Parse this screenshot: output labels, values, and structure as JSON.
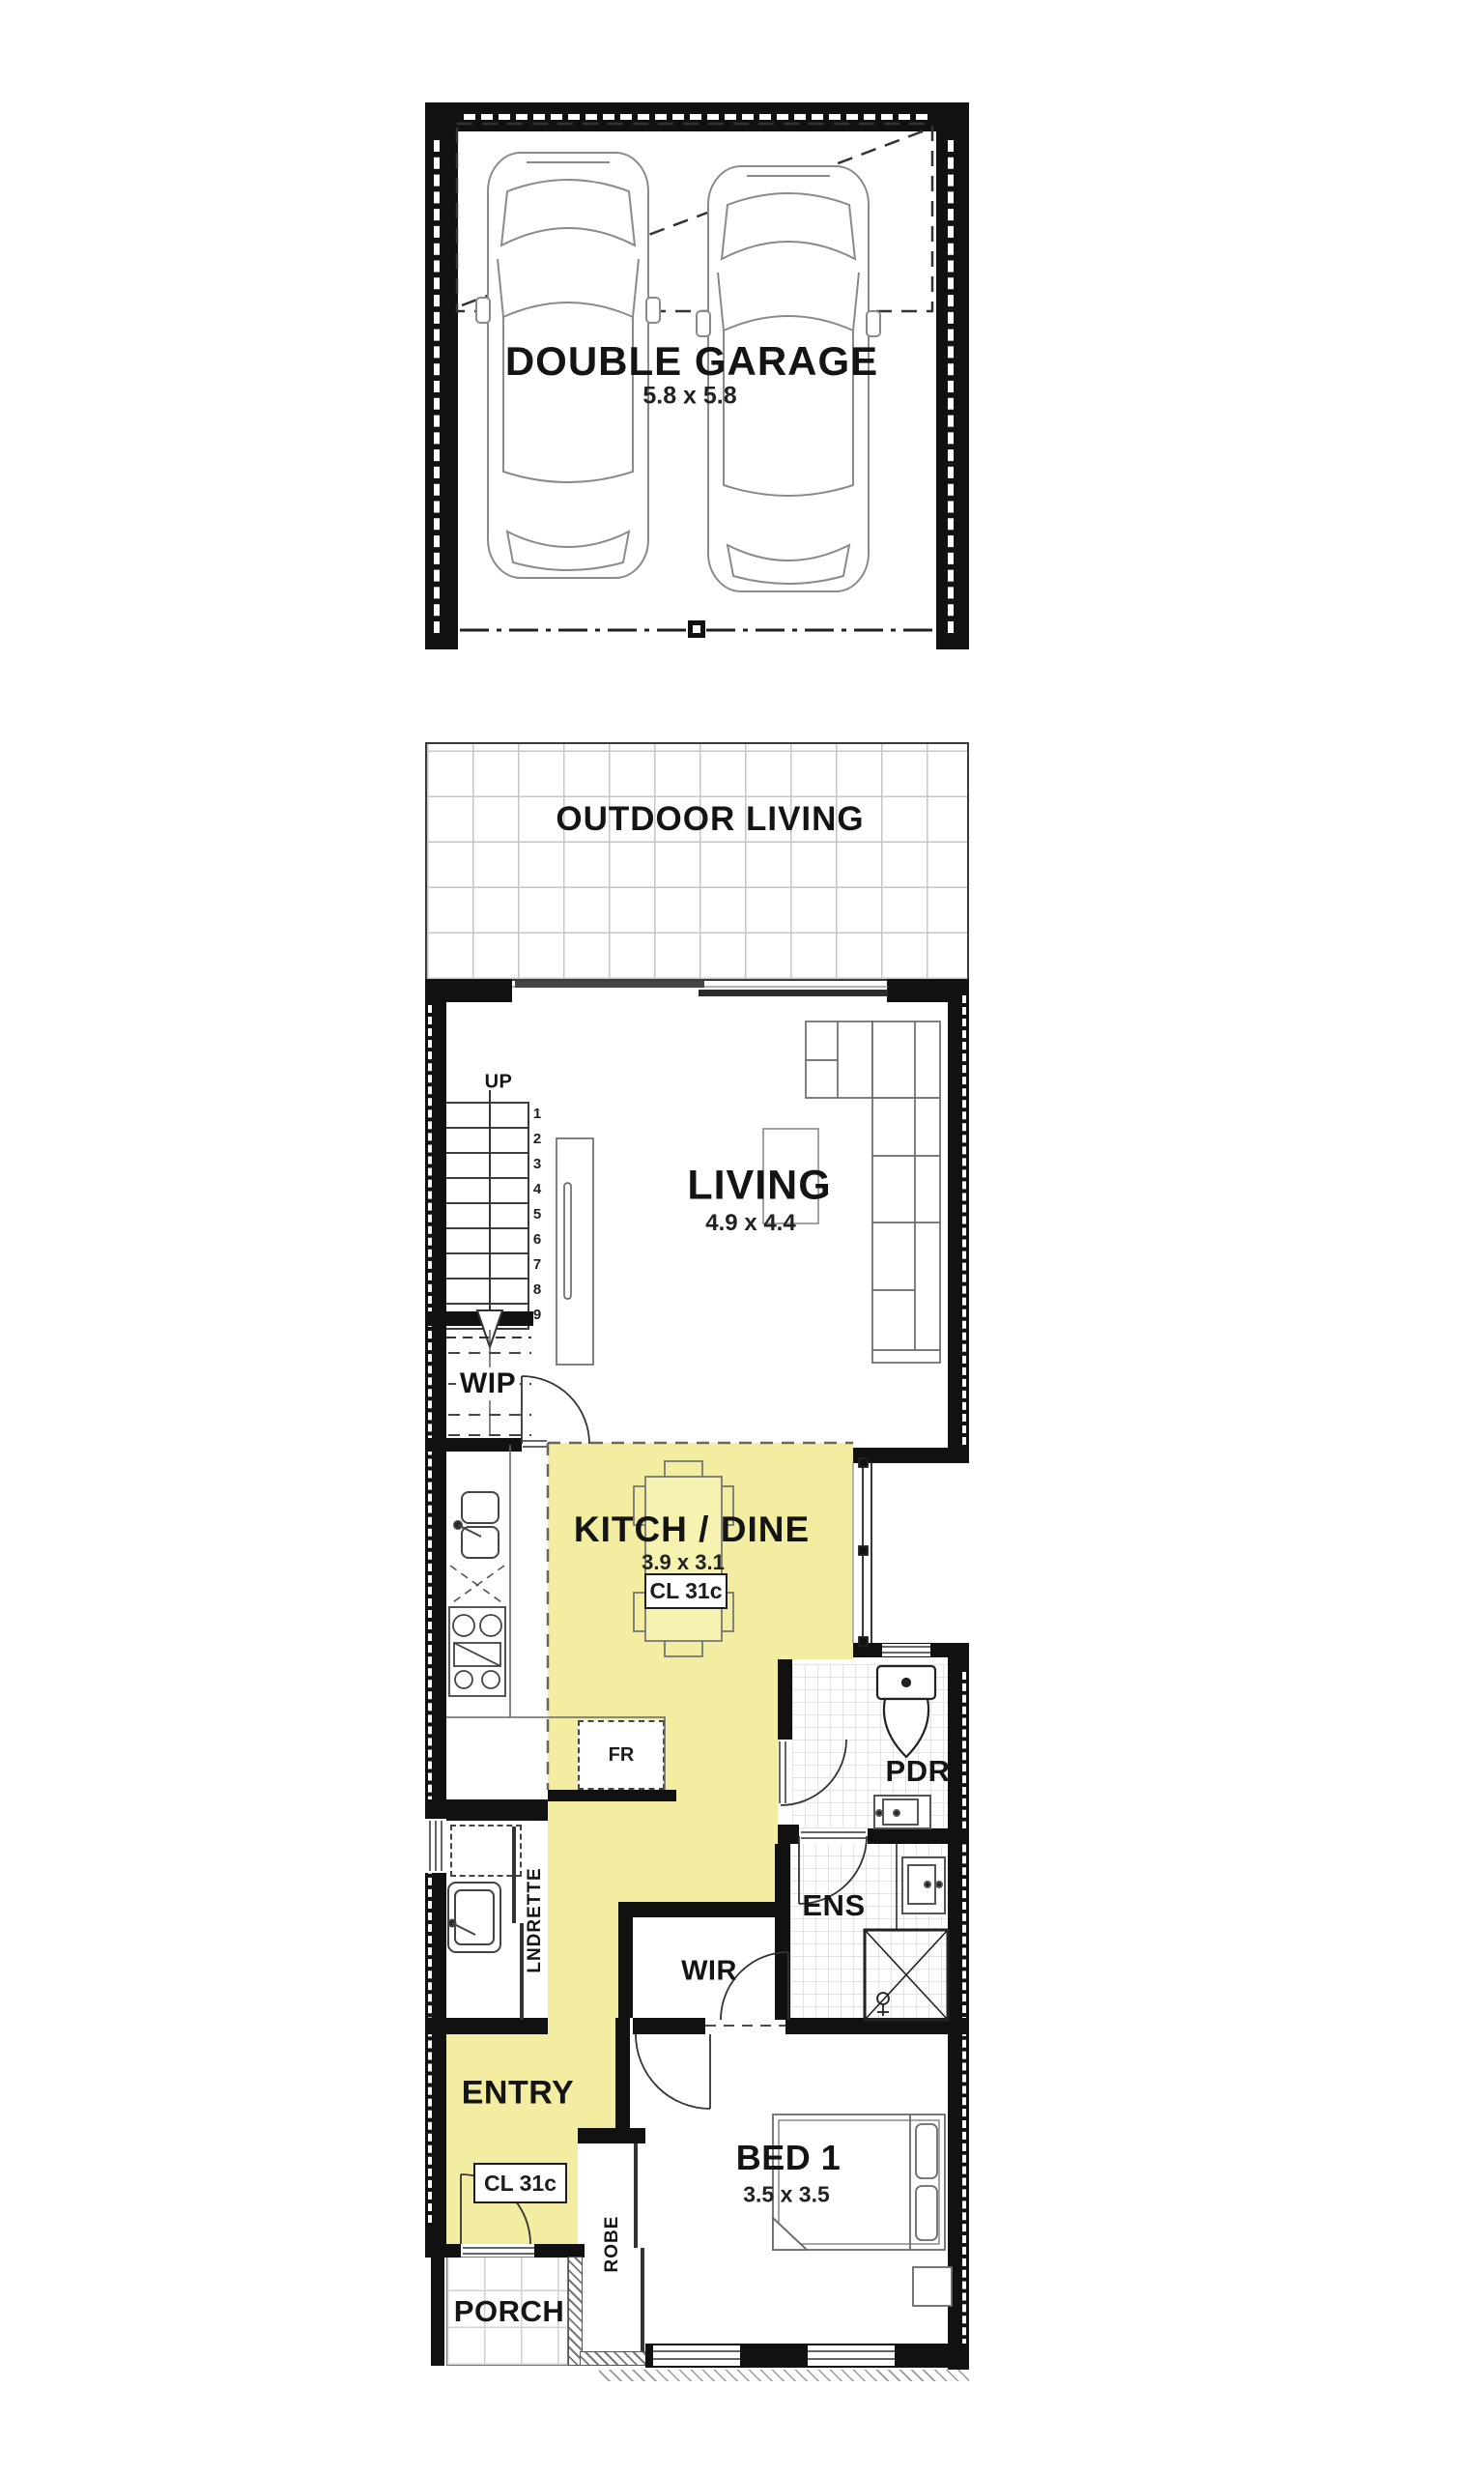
{
  "colors": {
    "highlight": "#F2EDA0",
    "wall": "#111111",
    "line": "#555555"
  },
  "garage": {
    "label": "DOUBLE GARAGE",
    "dim": "5.8 x 5.8"
  },
  "outdoor": {
    "label": "OUTDOOR LIVING"
  },
  "living": {
    "label": "LIVING",
    "dim": "4.9 x 4.4"
  },
  "stairs": {
    "up": "UP",
    "steps": [
      "1",
      "2",
      "3",
      "4",
      "5",
      "6",
      "7",
      "8",
      "9"
    ]
  },
  "wip": {
    "label": "WIP"
  },
  "kitchen": {
    "label": "KITCH / DINE",
    "dim": "3.9 x 3.1",
    "ceiling": "CL 31c",
    "fridge": "FR"
  },
  "pdr": {
    "label": "PDR"
  },
  "laundry": {
    "label": "LNDRETTE"
  },
  "ens": {
    "label": "ENS"
  },
  "wir": {
    "label": "WIR"
  },
  "entry": {
    "label": "ENTRY",
    "ceiling": "CL 31c"
  },
  "bed1": {
    "label": "BED 1",
    "dim": "3.5 x 3.5"
  },
  "robe": {
    "label": "ROBE"
  },
  "porch": {
    "label": "PORCH"
  }
}
